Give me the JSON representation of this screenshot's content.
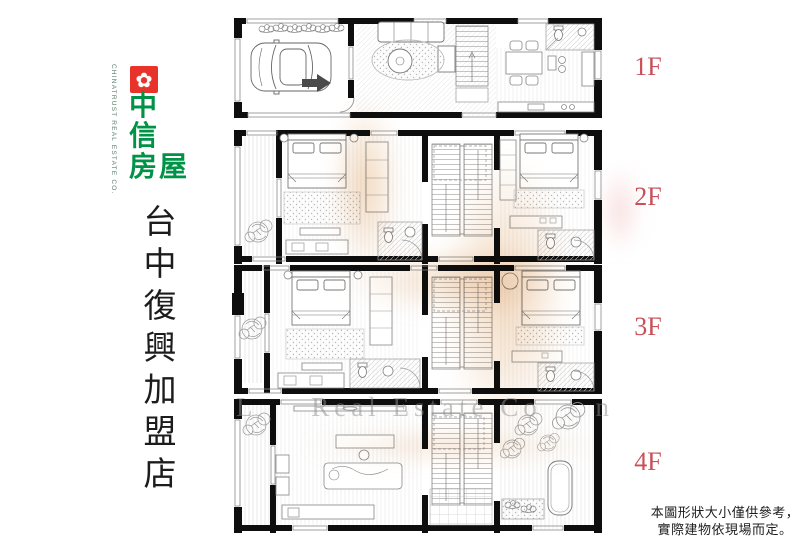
{
  "brand": {
    "english_vertical": "CHINATRUST REAL ESTATE CO.",
    "logo_flower_icon": "✿",
    "logo_line1": "中",
    "logo_line2": "信",
    "logo_line3": "房屋",
    "red": "#e8332a",
    "green": "#009347"
  },
  "store_banner": "台中復興加盟店",
  "floor_labels": {
    "f1": "1F",
    "f2": "2F",
    "f3": "3F",
    "f4": "4F"
  },
  "floor_label_color": "#c9505a",
  "disclaimer": {
    "line1": "本圖形狀大小僅供參考，",
    "line2": "實際建物依現場而定。"
  },
  "watermark": {
    "left": "L",
    "center": "Real Estate Co",
    "right": "n"
  }
}
